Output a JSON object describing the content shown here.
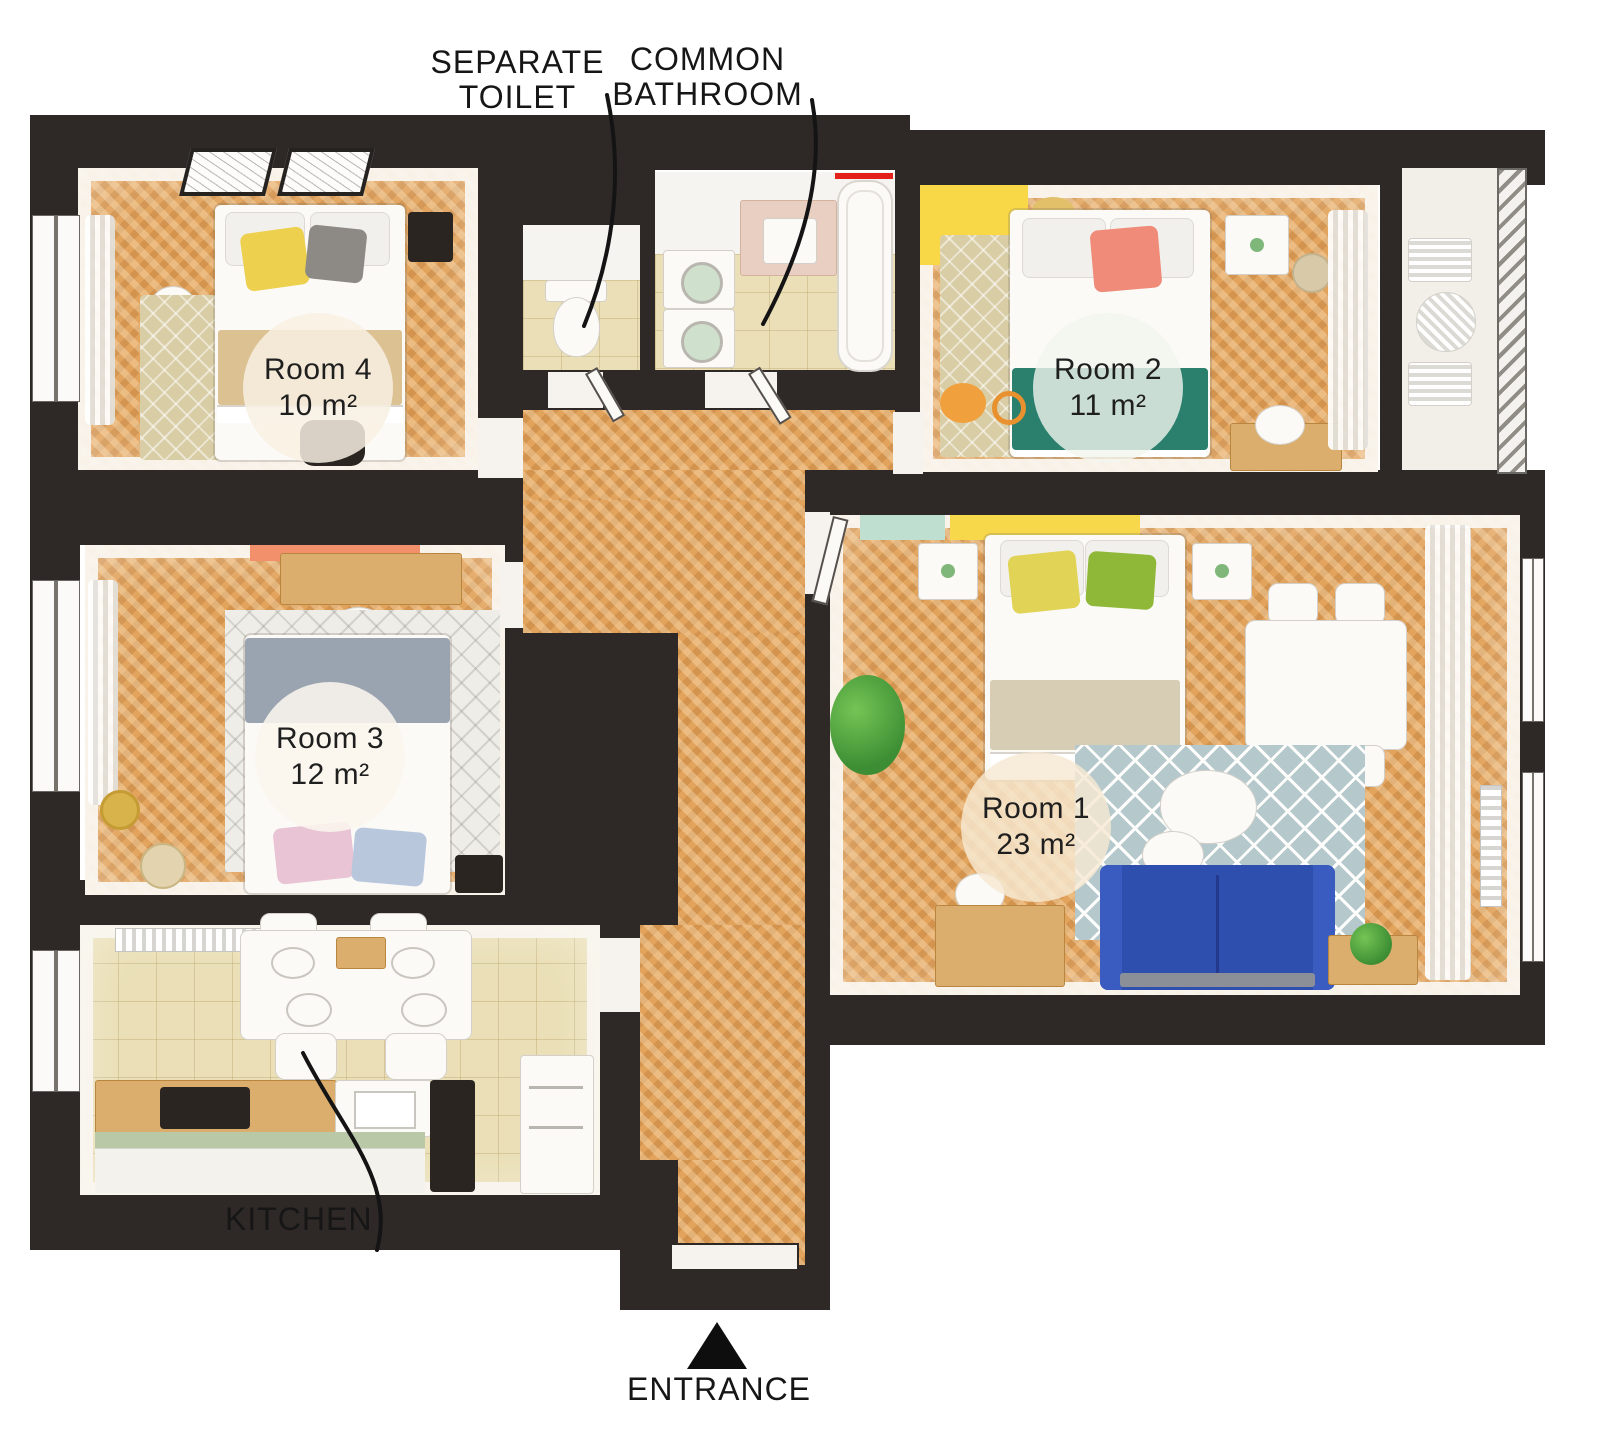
{
  "title": "Apartment floor plan with four rooms",
  "annotations": {
    "separate_toilet": "SEPARATE\nTOILET",
    "common_bathroom": "COMMON\nBATHROOM",
    "kitchen": "KITCHEN",
    "entrance": "ENTRANCE"
  },
  "rooms": [
    {
      "id": "room-4",
      "name": "Room 4",
      "area": "10 m²"
    },
    {
      "id": "room-2",
      "name": "Room 2",
      "area": "11 m²"
    },
    {
      "id": "room-3",
      "name": "Room 3",
      "area": "12 m²"
    },
    {
      "id": "room-1",
      "name": "Room 1",
      "area": "23 m²"
    }
  ],
  "colors": {
    "wall": "#2e2927",
    "wood_floor": "#e2a35c",
    "tile_floor": "#eadfb6",
    "accent_yellow": "#f7d84a",
    "accent_teal": "#2a7f6d",
    "accent_coral": "#ef8b78",
    "accent_orange_wall": "#f2906b",
    "sofa_blue": "#2f4fae",
    "accent_mint": "#bfe0d0",
    "rug_blue_gray": "#b5c8cc",
    "towel_bar_red": "#e32119",
    "label_text": "#161616"
  }
}
